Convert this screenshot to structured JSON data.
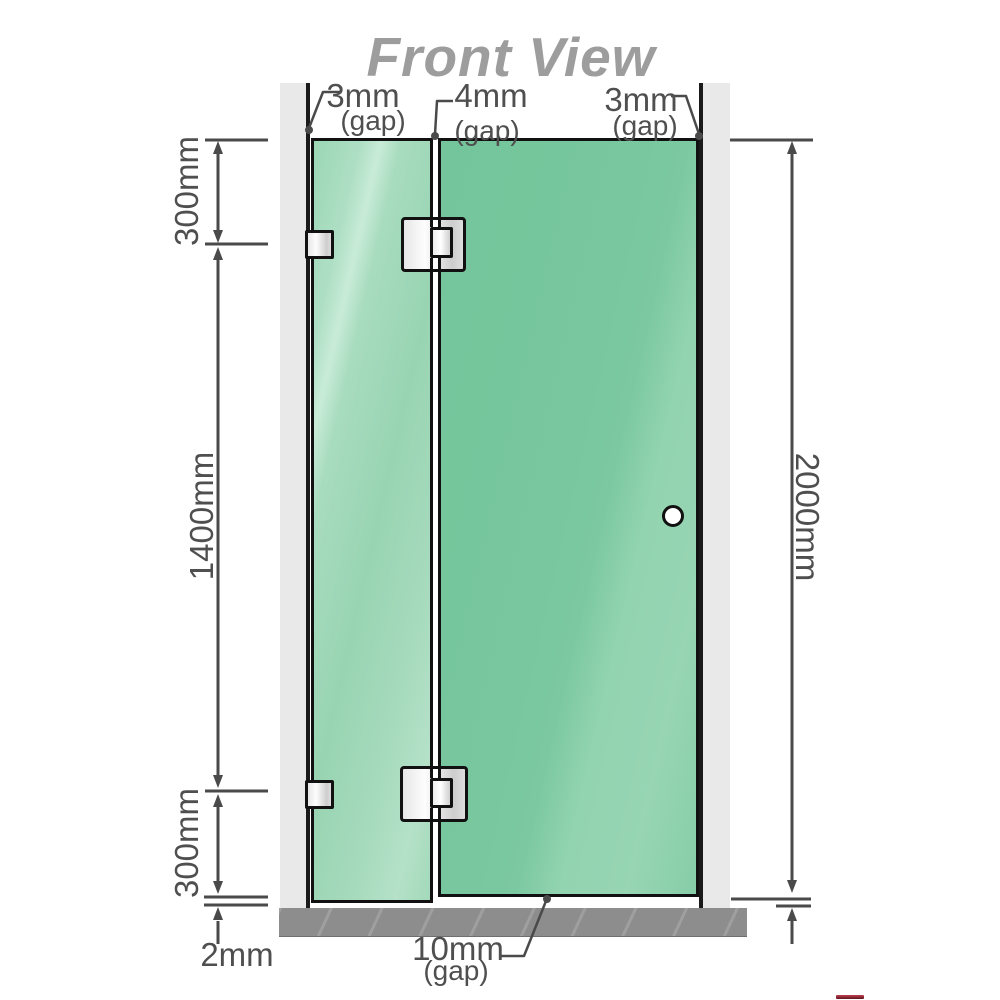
{
  "title": "Front View",
  "gaps": {
    "left": {
      "value": "3mm",
      "label": "(gap)"
    },
    "middle": {
      "value": "4mm",
      "label": "(gap)"
    },
    "right": {
      "value": "3mm",
      "label": "(gap)"
    },
    "bottom": {
      "value": "10mm",
      "label": "(gap)"
    }
  },
  "dimensions": {
    "left_top": "300mm",
    "left_middle": "1400mm",
    "left_bottom": "300mm",
    "right_total": "2000mm",
    "floor_clearance": "2mm"
  },
  "colors": {
    "glass_green_door": "#78c79e",
    "glass_green_fixed": "#a6dbbe",
    "wall_post_gray": "#e9e9e9",
    "floor_gray": "#8d8d8d",
    "outline_black": "#111111",
    "dimension_gray": "#4a4a4a",
    "title_gray": "#9d9d9d",
    "logo_red": "#8c1f2f"
  }
}
